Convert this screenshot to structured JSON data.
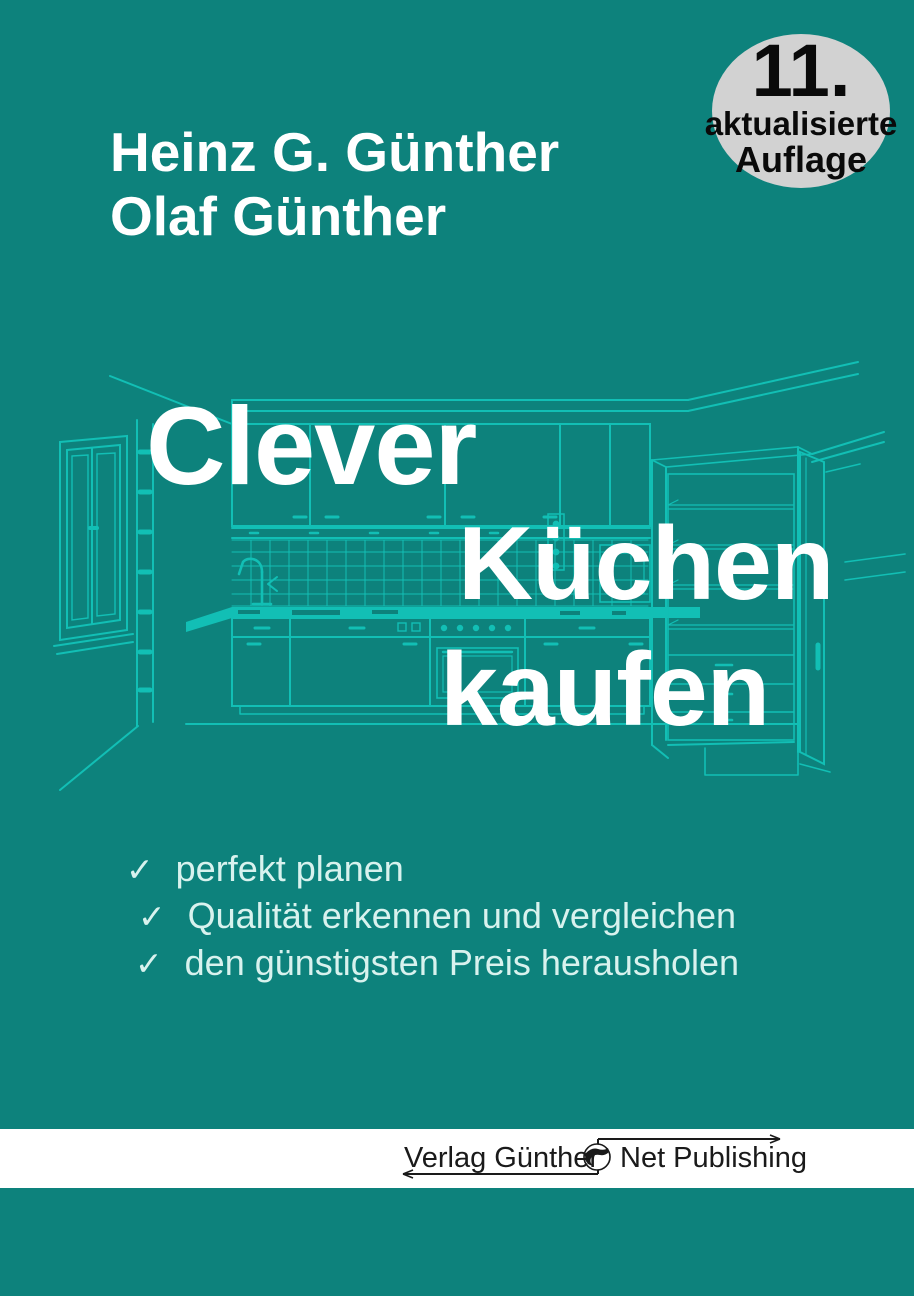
{
  "cover": {
    "background_color": "#0d827c",
    "line_art_color": "#12bfb5",
    "illustration": "kitchen-outline-drawing",
    "authors": {
      "line1": "Heinz G. Günther",
      "line2": "Olaf Günther",
      "color": "#ffffff"
    },
    "badge": {
      "line1": "11.",
      "line2": "aktualisierte",
      "line3": "Auflage",
      "bg_color": "#d2d2d2",
      "text_color": "#0a0a0a"
    },
    "title": {
      "line1": "Clever",
      "line2": "Küchen",
      "line3": "kaufen",
      "color": "#ffffff"
    },
    "bullets": [
      {
        "check": "✓",
        "text": "perfekt planen"
      },
      {
        "check": "✓",
        "text": "Qualität erkennen und vergleichen"
      },
      {
        "check": "✓",
        "text": "den günstigsten Preis herausholen"
      }
    ],
    "bullets_color": "#d8f2ee",
    "publisher": {
      "band_color": "#ffffff",
      "name_left": "Verlag Günther",
      "name_right": "Net Publishing",
      "globe_icon": "globe-icon",
      "text_color": "#1a1a1a"
    }
  }
}
